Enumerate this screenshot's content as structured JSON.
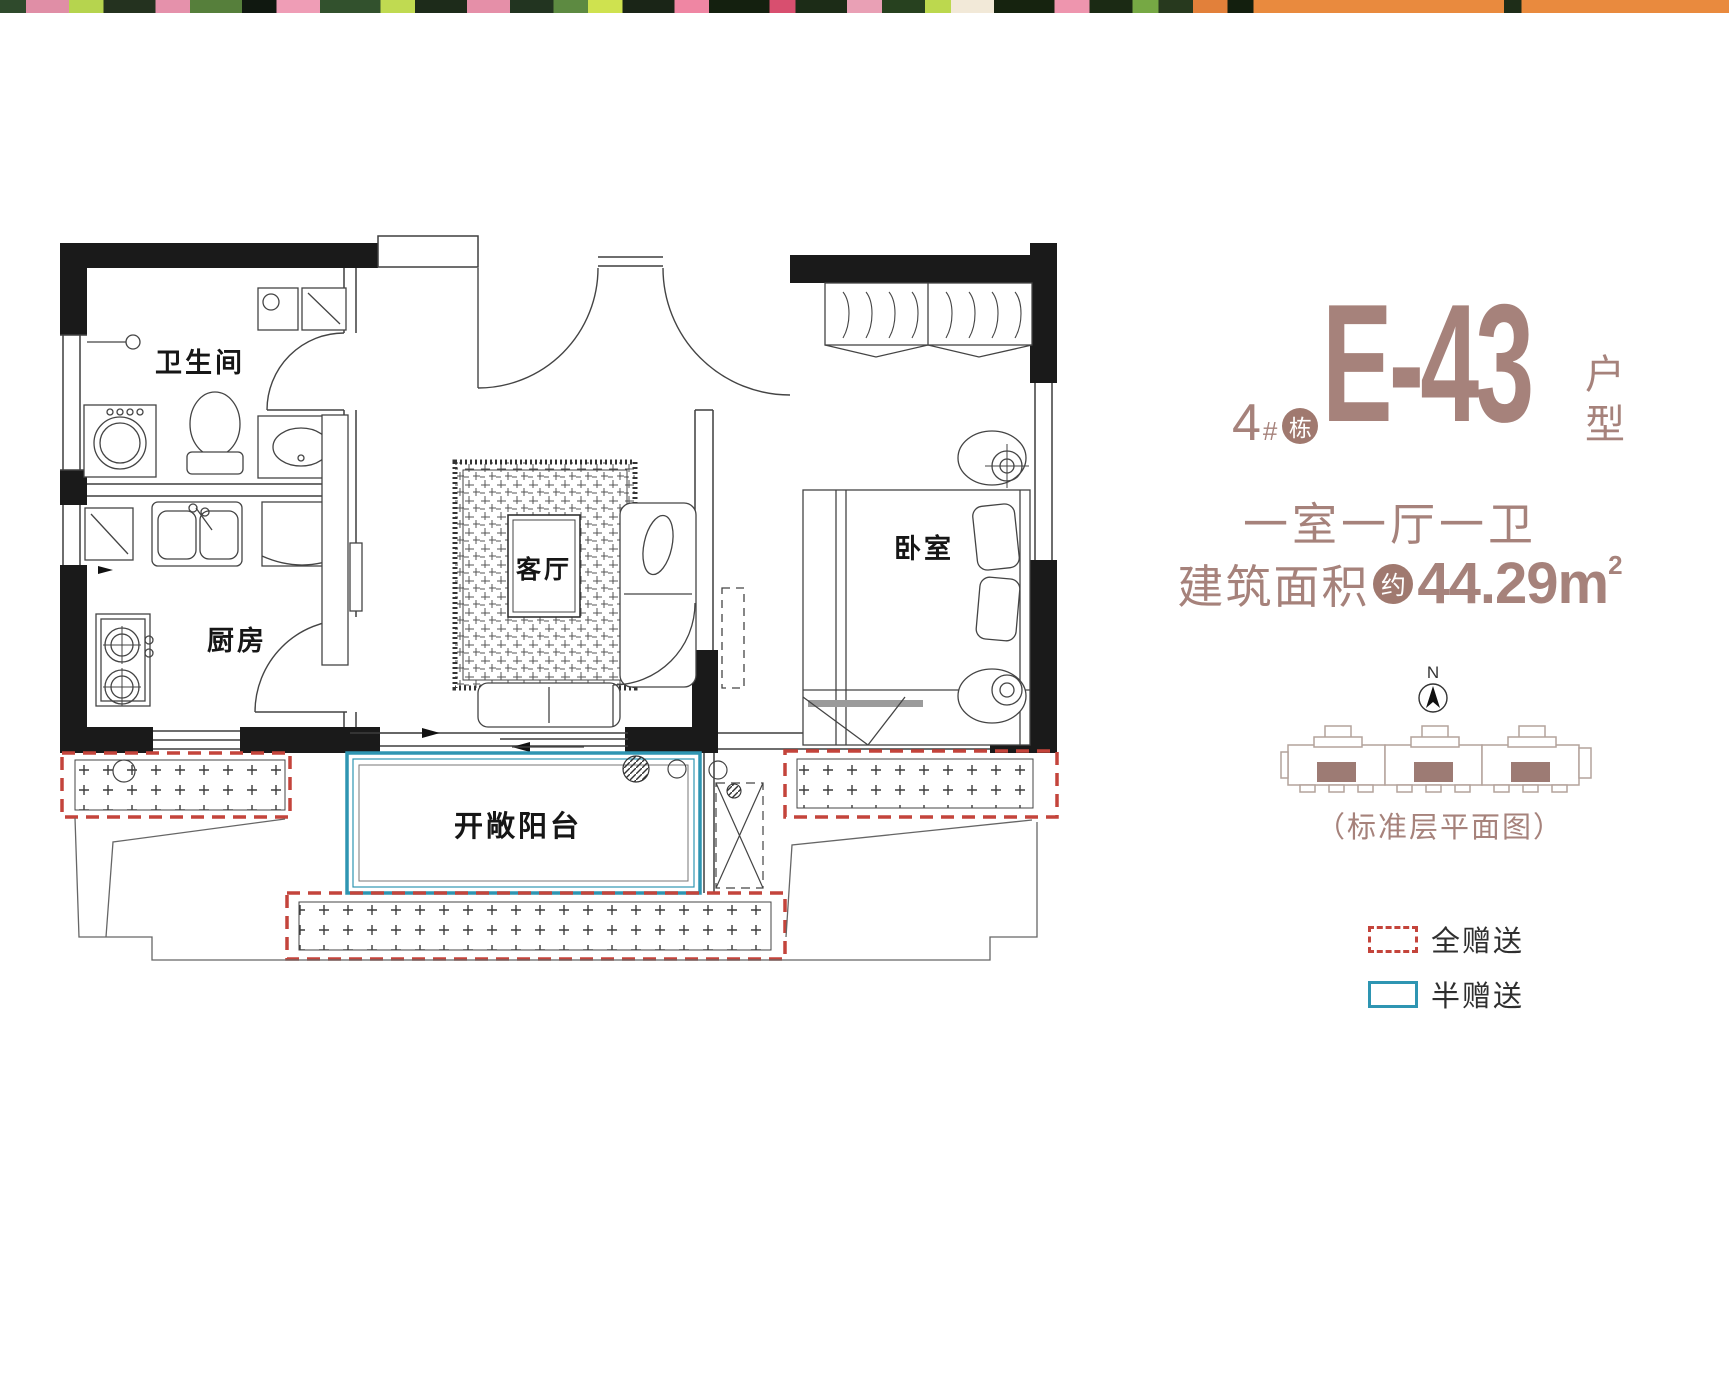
{
  "title": {
    "building_number": "4",
    "building_hash": "#",
    "building_badge": "栋",
    "unit_code": "E-43",
    "suffix_top": "户",
    "suffix_bottom": "型"
  },
  "summary": {
    "layout": "一室一厅一卫",
    "area_label": "建筑面积",
    "area_badge": "约",
    "area_value": "44.29m",
    "area_superscript": "2"
  },
  "compass": {
    "north_label": "N"
  },
  "keyplan": {
    "caption": "（标准层平面图）"
  },
  "legend": {
    "items": [
      {
        "label": "全赠送",
        "swatch": "red-dashed"
      },
      {
        "label": "半赠送",
        "swatch": "blue-solid"
      }
    ]
  },
  "floorplan": {
    "rooms": [
      {
        "label": "卫生间"
      },
      {
        "label": "厨房"
      },
      {
        "label": "客厅"
      },
      {
        "label": "卧室"
      },
      {
        "label": "开敞阳台"
      }
    ]
  },
  "colors": {
    "accent_brown": "#a6827b",
    "badge_brown": "#a0796f",
    "gift_full_red": "#c4443b",
    "gift_half_blue": "#2e95b2",
    "wall_black": "#1a1a1a",
    "keyplan_fill": "#9d7b74"
  }
}
